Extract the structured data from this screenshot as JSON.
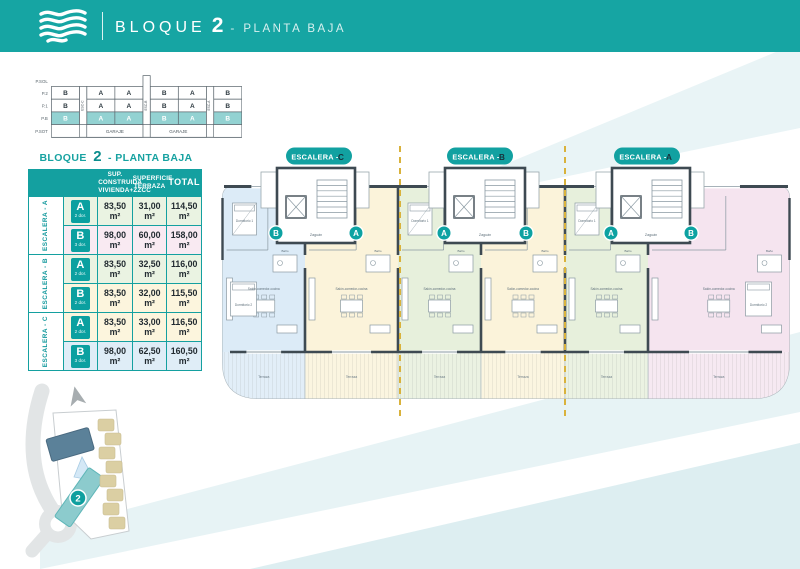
{
  "header": {
    "title_block": "BLOQUE",
    "title_number": "2",
    "dash": "-",
    "title_rest": "PLANTA BAJA",
    "logo_icon": "wave-logo-icon",
    "teal": "#16a5a3"
  },
  "stack_diagram": {
    "row_labels": [
      "P.SOL",
      "P.2",
      "P.1",
      "P.B",
      "P.SOT"
    ],
    "unit_rows": {
      "P.2": [
        "B",
        "A",
        "A",
        "B",
        "A",
        "B"
      ],
      "P.1": [
        "B",
        "A",
        "A",
        "B",
        "A",
        "B"
      ],
      "P.B": [
        "B",
        "A",
        "A",
        "B",
        "A",
        "B"
      ]
    },
    "stair_labels": [
      "ESC-C",
      "ESC-B",
      "ESC-A"
    ],
    "garage_labels": [
      "GARAJE",
      "GARAJE"
    ],
    "highlight_row": "P.B",
    "highlight_color": "#93d2d2"
  },
  "area_table": {
    "title_parts": [
      "BLOQUE",
      "2",
      "- PLANTA BAJA"
    ],
    "headers": [
      "SUP. CONSTRUIDA\nVIVIENDA+ZZCC",
      "SUPERFICIE\nTERRAZA",
      "TOTAL"
    ],
    "groups": [
      {
        "name": "ESCALERA - A",
        "rows": [
          {
            "type": "A",
            "dorm": "2 dor.",
            "sup": "83,50 m²",
            "terraza": "31,00 m²",
            "total": "114,50 m²",
            "bg": "#eaf3e2"
          },
          {
            "type": "B",
            "dorm": "3 dor.",
            "sup": "98,00 m²",
            "terraza": "60,00 m²",
            "total": "158,00 m²",
            "bg": "#f9eaf2"
          }
        ]
      },
      {
        "name": "ESCALERA - B",
        "rows": [
          {
            "type": "A",
            "dorm": "2 dor.",
            "sup": "83,50 m²",
            "terraza": "32,50 m²",
            "total": "116,00 m²",
            "bg": "#eaf3e2"
          },
          {
            "type": "B",
            "dorm": "2 dor.",
            "sup": "83,50 m²",
            "terraza": "32,00 m²",
            "total": "115,50 m²",
            "bg": "#fcf5dd"
          }
        ]
      },
      {
        "name": "ESCALERA - C",
        "rows": [
          {
            "type": "A",
            "dorm": "2 dor.",
            "sup": "83,50 m²",
            "terraza": "33,00 m²",
            "total": "116,50 m²",
            "bg": "#fcf5dd"
          },
          {
            "type": "B",
            "dorm": "3 dor.",
            "sup": "98,00 m²",
            "terraza": "62,50 m²",
            "total": "160,50 m²",
            "bg": "#dfedf7"
          }
        ]
      }
    ]
  },
  "plan": {
    "escalera_pills": [
      {
        "prefix": "ESCALERA - ",
        "letter": "C"
      },
      {
        "prefix": "ESCALERA - ",
        "letter": "B"
      },
      {
        "prefix": "ESCALERA - ",
        "letter": "A"
      }
    ],
    "apartment_colors": {
      "blue": "#dcebf7",
      "cream": "#fbf3da",
      "green": "#e7f0dc",
      "pink": "#f5e4ef"
    },
    "badges": [
      "B",
      "A",
      "A",
      "B",
      "A",
      "B"
    ],
    "room_labels": {
      "terraza": "Terraza",
      "dorm1": "Dormitorio 1",
      "dorm2": "Dormitorio 2",
      "salon": "Salón-comedor-cocina",
      "bano": "Baño",
      "zaguan": "Zaguán"
    },
    "dashed_line_color": "#d9b23c",
    "wall_color": "#3e4a52",
    "pill_color": "#12a1a1"
  },
  "site_map": {
    "north_label": "N",
    "block_badge": "2",
    "badge_color": "#0f9f9f",
    "building1_color": "#5b8199",
    "building2_color": "#8ccbcd",
    "houses_color": "#dbcfa3"
  }
}
